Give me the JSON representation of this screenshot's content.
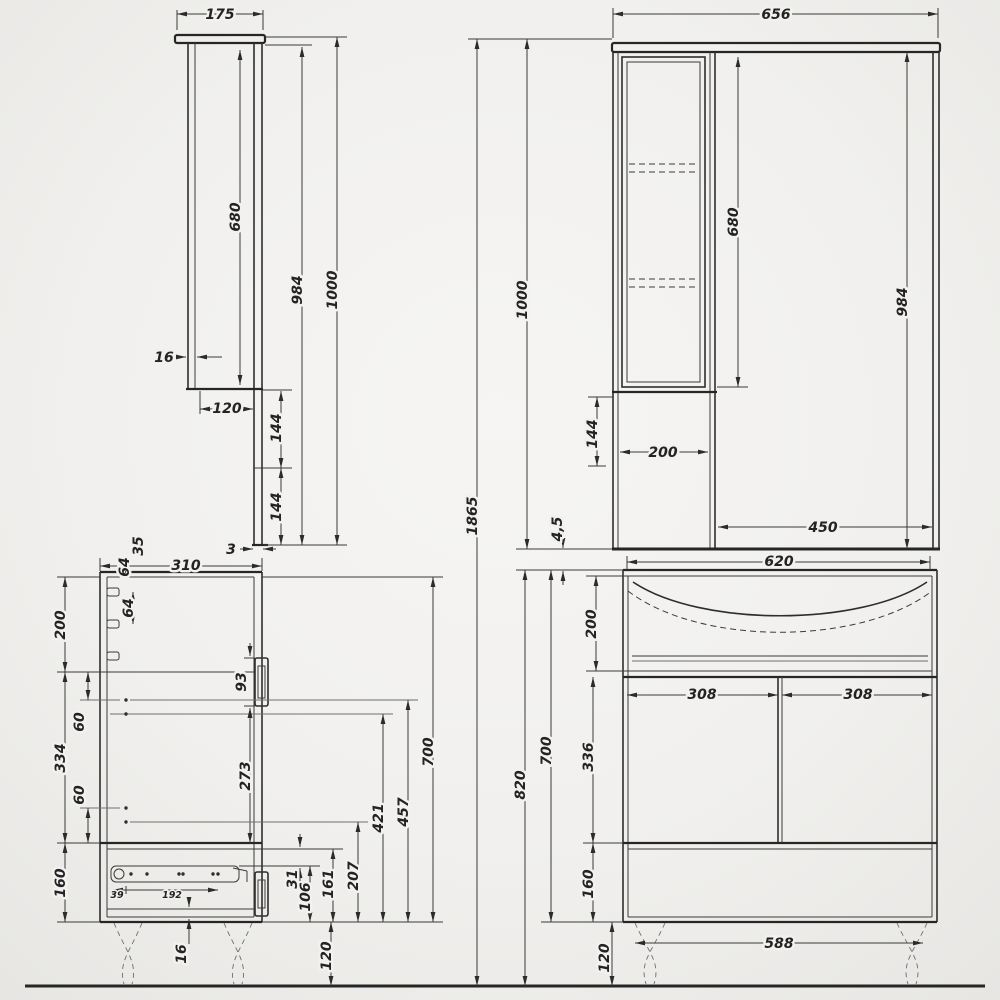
{
  "document": {
    "type": "furniture-technical-drawing",
    "subject": "bathroom vanity with sink cabinet and mirror cabinet, four orthographic views with dimensions (mm)",
    "palette": {
      "ink": "#2b2b2b",
      "paper": "#f2f1ef"
    }
  },
  "views": {
    "mirror_side": {
      "name": "mirror-cabinet-side-view",
      "dims": {
        "width": "175",
        "inner_height": "680",
        "height_no_top": "984",
        "total_height": "1000",
        "panel_thickness": "16",
        "lower_depth": "120",
        "lower_upper": "144",
        "lower_lower": "144",
        "back_thickness": "3"
      }
    },
    "mirror_front": {
      "name": "mirror-cabinet-front-view",
      "dims": {
        "width": "656",
        "inner_height": "680",
        "height_no_top": "984",
        "total_height": "1000",
        "overall_height": "1865",
        "niche_height": "144",
        "niche_width": "200",
        "mirror_width": "450",
        "gap": "4,5"
      }
    },
    "vanity_side": {
      "name": "vanity-cabinet-side-view",
      "dims": {
        "depth": "310",
        "peg_offset": "35",
        "peg_gap_a": "64",
        "peg_gap_b": "64",
        "top_section": "200",
        "pin_upper": "60",
        "mid_section": "334",
        "pin_lower": "60",
        "bottom_section": "160",
        "handle_upper": "93",
        "handle_pos": "273",
        "shelf_from_bottom": "421",
        "pin_from_bottom": "457",
        "height": "700",
        "pin2_from_bottom": "207",
        "drawer_zone": "161",
        "slide_height": "106",
        "slide_gap": "31",
        "handle_lower": "93",
        "slide_front": "39",
        "slide_span": "192",
        "bottom_thickness": "16",
        "leg_height": "120"
      }
    },
    "vanity_front": {
      "name": "vanity-cabinet-front-view",
      "dims": {
        "width": "620",
        "sink_height": "200",
        "door_width_left": "308",
        "door_width_right": "308",
        "door_height": "336",
        "height": "700",
        "height_with_legs": "820",
        "drawer_height": "160",
        "leg_span": "588",
        "leg_height": "120"
      }
    }
  }
}
